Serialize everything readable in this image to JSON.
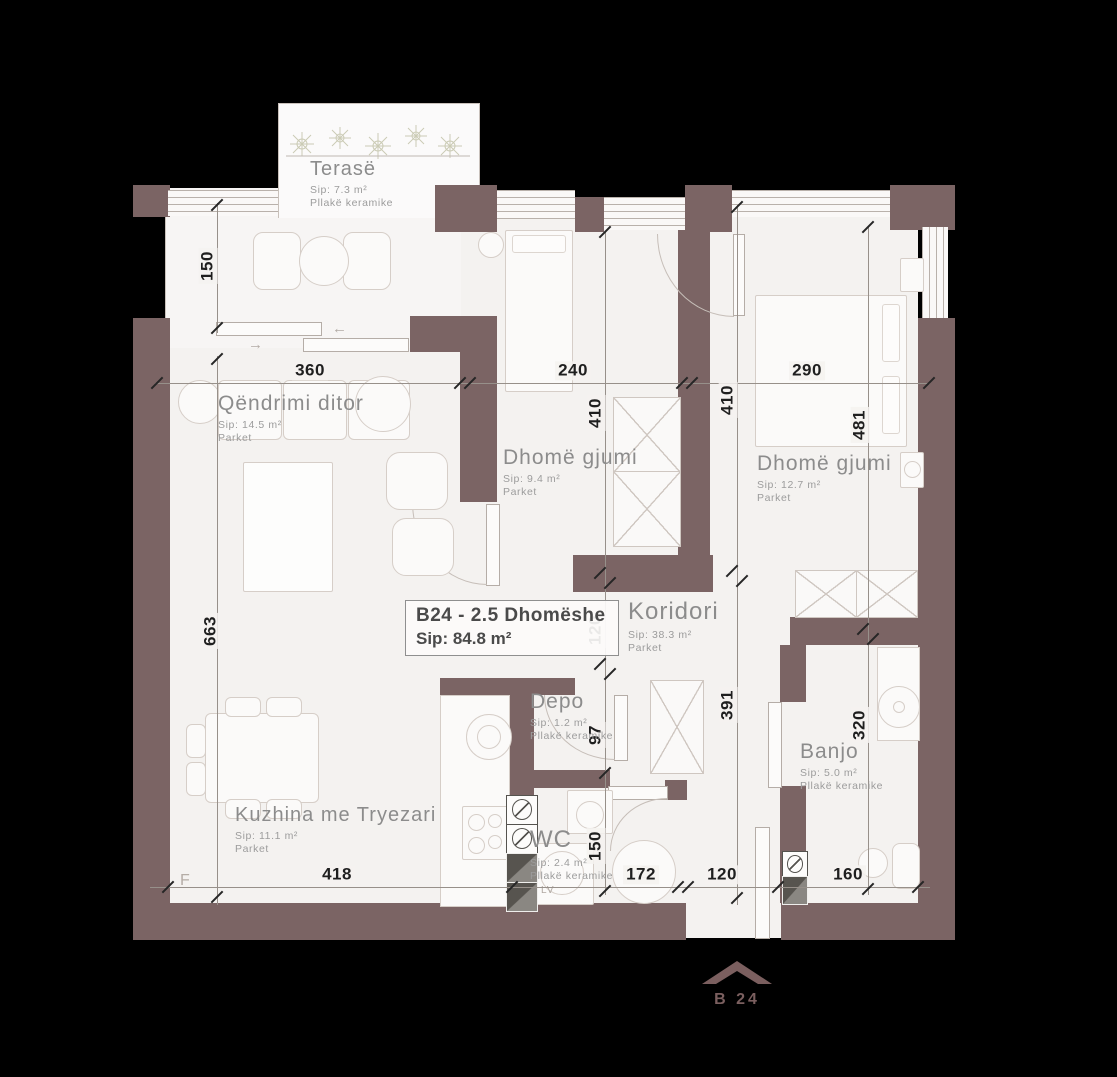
{
  "unit": {
    "code_line": "B24 - 2.5 Dhomëshe",
    "area_line": "Sip: 84.8 m²"
  },
  "rooms": {
    "terase": {
      "name": "Terasë",
      "area": "Sip: 7.3 m²",
      "floor": "Pllakë keramike"
    },
    "qendrimi": {
      "name": "Qëndrimi ditor",
      "area": "Sip: 14.5 m²",
      "floor": "Parket"
    },
    "dhome_gjumi_1": {
      "name": "Dhomë gjumi",
      "area": "Sip: 9.4 m²",
      "floor": "Parket"
    },
    "dhome_gjumi_2": {
      "name": "Dhomë gjumi",
      "area": "Sip: 12.7 m²",
      "floor": "Parket"
    },
    "koridori": {
      "name": "Koridori",
      "area": "Sip: 38.3 m²",
      "floor": "Parket"
    },
    "depo": {
      "name": "Depo",
      "area": "Sip: 1.2 m²",
      "floor": "Pllakë keramike"
    },
    "wc": {
      "name": "WC",
      "area": "Sip: 2.4 m²",
      "floor": "Pllakë keramike"
    },
    "banjo": {
      "name": "Banjo",
      "area": "Sip: 5.0 m²",
      "floor": "Pllakë keramike"
    },
    "kuzhina": {
      "name": "Kuzhina me Tryezari",
      "area": "Sip: 11.1 m²",
      "floor": "Parket"
    }
  },
  "dimensions": {
    "top": [
      "360",
      "240",
      "290"
    ],
    "bottom": [
      "418",
      "172",
      "120",
      "160"
    ],
    "left": [
      "150",
      "663"
    ],
    "col_a": [
      "410",
      "120",
      "97",
      "150"
    ],
    "col_b": [
      "410",
      "391"
    ],
    "col_c": [
      "481",
      "320"
    ]
  },
  "annotations": {
    "f_marker": "F",
    "washing_machine": "LV"
  },
  "icons": {
    "slide_left": "←",
    "slide_right": "→"
  },
  "logo": {
    "text": "B 24"
  },
  "colors": {
    "background": "#000000",
    "wall": "#7b6464",
    "floor": "#f4f2f0",
    "line": "#c9c1bb",
    "dimension_text": "#1f1f1f",
    "label_text": "#8c8c8c",
    "logo": "#7b5f5f"
  }
}
